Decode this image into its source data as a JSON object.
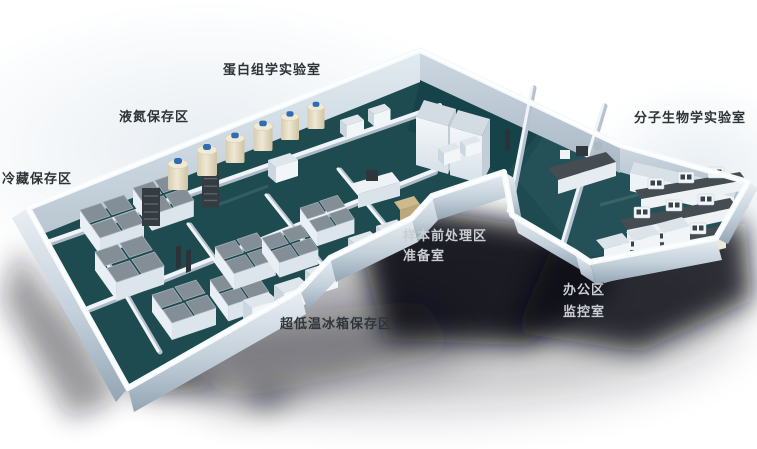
{
  "labels": {
    "proteomics_lab": "蛋白组学实验室",
    "liquid_nitrogen_storage": "液氮保存区",
    "cold_storage": "冷藏保存区",
    "molecular_biology_lab": "分子生物学实验室",
    "sample_pretreatment": "样本前处理区",
    "preparation_room": "准备室",
    "office_area": "办公区",
    "monitoring_room": "监控室",
    "ult_freezer_storage": "超低温冰箱保存区"
  },
  "colors": {
    "floor-teal": "#1d4b50",
    "floor-teal-dark": "#16434a",
    "floor-teal-right": "#235157",
    "wall-top": "#f6fafd",
    "freezer-gray": "#848e96",
    "tank-cream": "#e7dfc8",
    "tank-cap-blue": "#2f6cb3",
    "bench-dark": "#454d53",
    "label-dark": "#2e3338",
    "label-light": "#c9ced2",
    "shadow": "#0b1114"
  }
}
